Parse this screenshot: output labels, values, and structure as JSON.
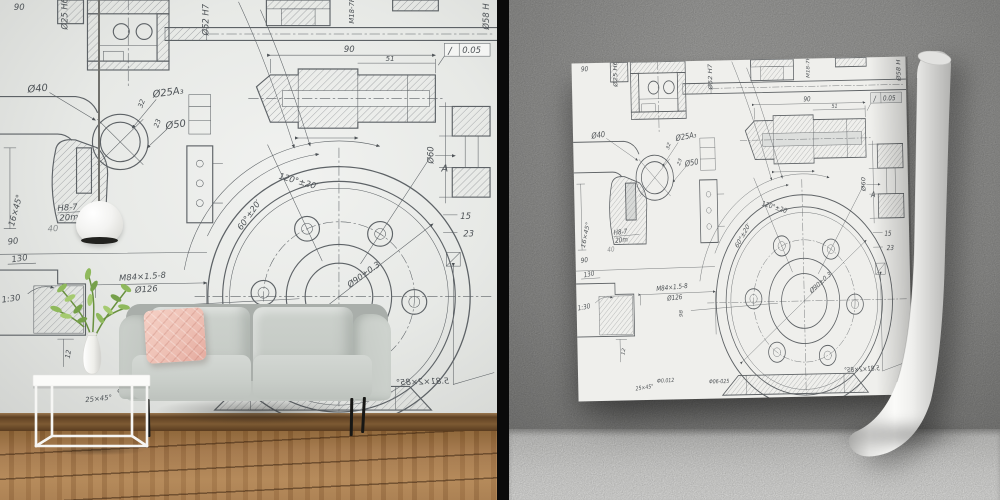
{
  "scene": {
    "left_panel": "living room with blueprint wallpaper, gray sofa, pink pillow, pendant lamp, white tray table with plant",
    "right_panel": "blueprint wallpaper sheet mockup curling into a roll on gray wall"
  },
  "colors": {
    "divider": "#0a0a0a",
    "left_wall": "#e9ebe8",
    "right_wall": "#a5a5a3",
    "right_floor": "#e9e9e7",
    "blueprint_line": "#5d6266",
    "sofa": "#c8cdc8",
    "pillow": "#eec0b4",
    "wood_floor": "#a2764a",
    "baseboard": "#7d5a33",
    "sheet": "#efefec",
    "lamp": "#f6f6f4",
    "plant_leaf": "#8fb95c",
    "sofa_leg": "#171715"
  },
  "blueprint": {
    "labels": {
      "b90a": "90",
      "d25h6": "Ø25 H6",
      "d52h7": "Ø52 H7",
      "d58h": "Ø58 H",
      "m18": "M18-7H",
      "s90": "90",
      "s51": "51",
      "tolsym": "∕",
      "tol": "0.05",
      "d60": "Ø60",
      "aview": "A",
      "d15": "15",
      "d23a": "23",
      "d40": "Ø40",
      "d25a3": "Ø25A₃",
      "d50": "Ø50",
      "r32": "32",
      "r23": "23",
      "cham16": "16×45°",
      "h87": "H8-7",
      "mm20": "20m",
      "n40": "40",
      "b90b": "90",
      "d130": "130",
      "taper": "1:30",
      "d12": "12",
      "m84": "M84×1.5-8",
      "d126": "Ø126",
      "d98": "98",
      "f0012": "Ф0.012",
      "cham25": "25×45°",
      "ang120": "120°±20′",
      "ang60": "60°±20′",
      "d90pm": "Ø90±0.3",
      "mirror": "5.81×2×85°",
      "fit": "Φ06-025"
    }
  }
}
